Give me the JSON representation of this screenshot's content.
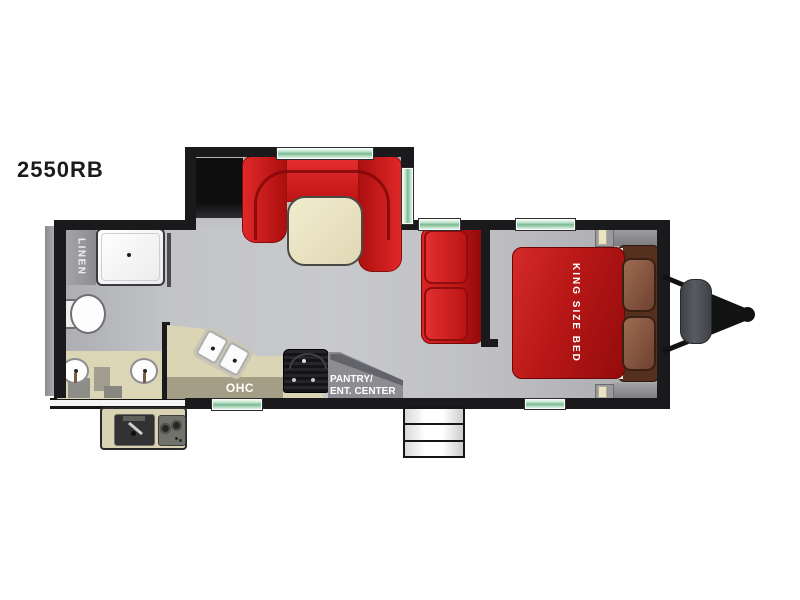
{
  "title": "2550RB",
  "labels": {
    "linen": "LINEN",
    "ohc": "OHC",
    "pantry_line1": "PANTRY/",
    "pantry_line2": "ENT. CENTER",
    "king_bed": "KING SIZE BED"
  },
  "colors": {
    "accent_red": "#c41818",
    "window_green": "#9fd4b0",
    "counter_tan": "#dcd5b5",
    "table_cream": "#ece5c6",
    "pillow_brown": "#8a5a42",
    "wall_black": "#1a1a1c",
    "floor_gray": "#bcbdc0"
  },
  "fixtures": [
    "linen-closet",
    "shower",
    "toilet",
    "dual-vanity-sinks",
    "u-shaped-dinette",
    "dinette-table",
    "kitchen-double-sink",
    "overhead-cabinet",
    "range",
    "pantry-entertainment-center",
    "sofa",
    "king-size-bed",
    "nightstands",
    "entry-steps",
    "outdoor-kitchen",
    "propane-tanks",
    "trailer-hitch",
    "rear-bumper",
    "windows"
  ]
}
